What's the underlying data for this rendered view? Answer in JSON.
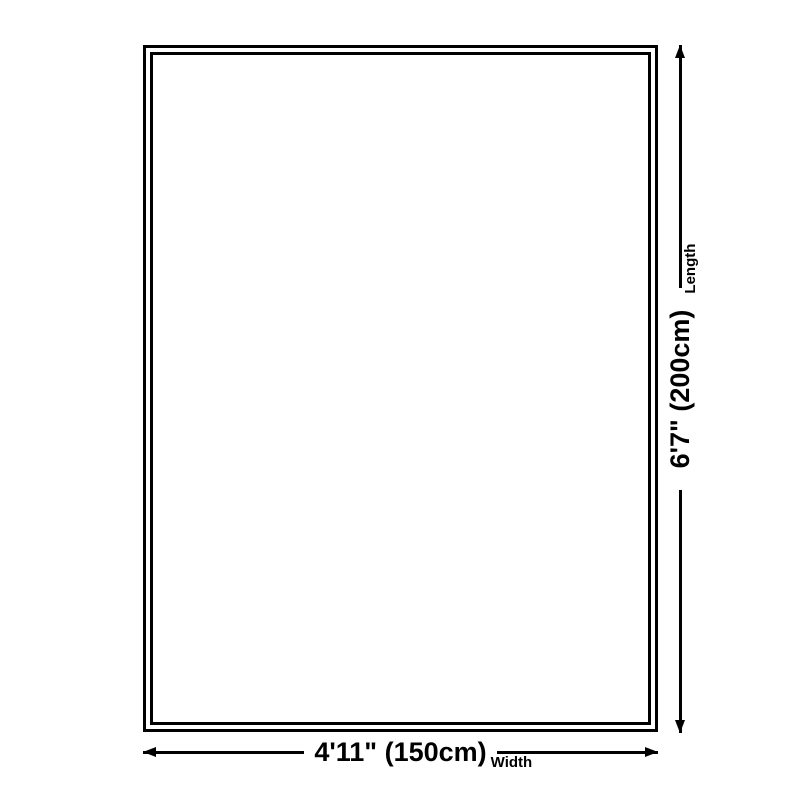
{
  "diagram": {
    "title": "rug-size-diagram",
    "colors": {
      "background": "#ffffff",
      "line": "#000000",
      "text": "#000000"
    },
    "width_dimension": {
      "value": "4'11\" (150cm)",
      "axis_label": "Width"
    },
    "length_dimension": {
      "value": "6'7\" (200cm)",
      "axis_label": "Length"
    }
  }
}
